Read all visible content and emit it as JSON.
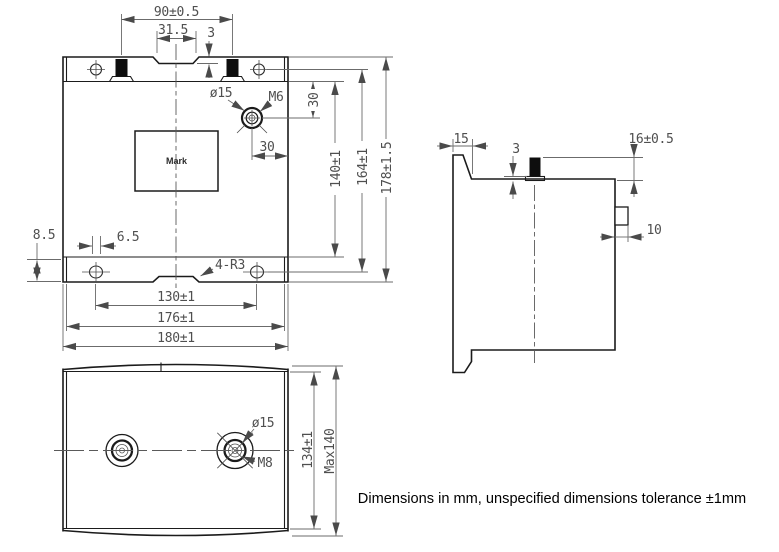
{
  "front_view": {
    "dims": {
      "post_spacing": "90±0.5",
      "notch_width": "31.5",
      "notch_depth": "3",
      "terminal_offset_top": "30",
      "terminal_offset_right": "30",
      "body_height": "140±1",
      "hole_spacing_vertical": "164±1",
      "total_height": "178±1.5",
      "hole_offset_bottom": "8.5",
      "slot_width": "6.5",
      "hole_spacing_horizontal": "130±1",
      "flange_width": "176±1",
      "total_width": "180±1",
      "corner_radius": "4-R3"
    },
    "labels": {
      "mark": "Mark",
      "terminal_dia": "ø15",
      "thread": "M6"
    }
  },
  "side_view": {
    "dims": {
      "flange_offset": "15",
      "base_thickness": "3",
      "terminal_height": "16±0.5",
      "boss_depth": "10"
    }
  },
  "bottom_view": {
    "dims": {
      "body_depth": "134±1",
      "max_depth": "Max140"
    },
    "labels": {
      "terminal_dia": "ø15",
      "thread": "M8"
    }
  },
  "footer": {
    "note": "Dimensions in mm, unspecified dimensions tolerance ±1mm"
  }
}
